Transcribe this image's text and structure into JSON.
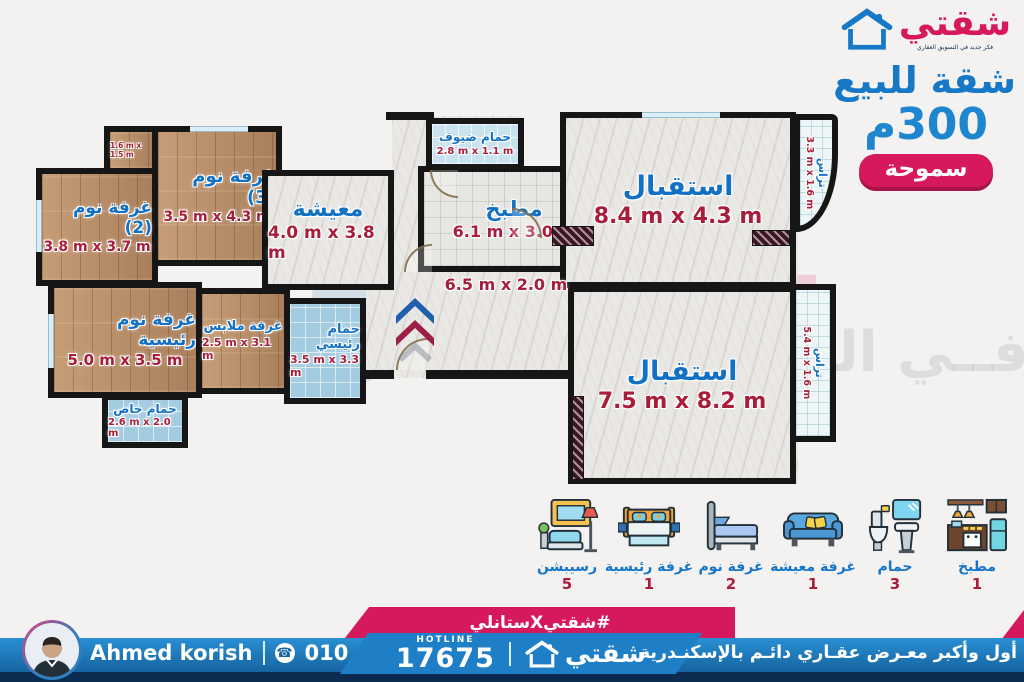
{
  "side_panel": {
    "logo_text": "شقتي",
    "logo_tagline": "فكر جديد في التسويق العقاري",
    "title": "شقة للبيع",
    "area": "300م",
    "location_badge": "سموحة"
  },
  "floor_plan": {
    "rooms": [
      {
        "name": "غرفة نوم (3)",
        "dims": "3.5 m x 4.3 m"
      },
      {
        "name": "غرفة نوم (2)",
        "dims": "3.8 m x 3.7 m"
      },
      {
        "name": "غرفة نوم رئيسية",
        "dims": "5.0 m x 3.5 m"
      },
      {
        "name": "غرفة ملابس",
        "dims": "2.5 m x 3.1 m"
      },
      {
        "name": "حمام رئيسي",
        "dims": "3.5 m x 3.3 m"
      },
      {
        "name": "حمام خاص",
        "dims": "2.6 m x 2.0 m"
      },
      {
        "name": "معيشة",
        "dims": "4.0 m x 3.8 m"
      },
      {
        "name": "حمام ضيوف",
        "dims": "2.8 m x 1.1 m"
      },
      {
        "name": "مطبخ",
        "dims": "6.1 m x 3.0 m"
      },
      {
        "name": "استقبال",
        "dims": "8.4 m x 4.3 m"
      },
      {
        "name": "استقبال",
        "dims": "7.5 m x 8.2 m"
      },
      {
        "name": "تراس",
        "dims": "3.3 m x 1.6 m"
      },
      {
        "name": "تراس",
        "dims": "5.4 m x 1.6 m"
      },
      {
        "name": "",
        "dims": "6.5 m x 2.0 m"
      },
      {
        "name": "",
        "dims": "1.6 m x 1.5 m"
      }
    ],
    "watermark_slogan": "فــي التســويــق العقــاري"
  },
  "legend": {
    "items": [
      {
        "label": "رسيبشن",
        "count": "5",
        "icon": "reception-icon"
      },
      {
        "label": "غرفة رئيسية",
        "count": "1",
        "icon": "master-bed-icon"
      },
      {
        "label": "غرفة نوم",
        "count": "2",
        "icon": "single-bed-icon"
      },
      {
        "label": "غرفة معيشة",
        "count": "1",
        "icon": "living-sofa-icon"
      },
      {
        "label": "حمام",
        "count": "3",
        "icon": "bathroom-icon"
      },
      {
        "label": "مطبخ",
        "count": "1",
        "icon": "kitchen-icon"
      }
    ]
  },
  "footer": {
    "agent_name": "Ahmed korish",
    "agent_phone": "010 400 633 90",
    "hashtag": "#شقتيXستانلي",
    "hotline_label": "HOTLINE",
    "hotline_number": "17675",
    "brand": "شقتي",
    "tagline": "أول وأكبر معـرض عقـاري دائـم بالإسكنـدرية"
  },
  "colors": {
    "primary_blue": "#1778c8",
    "magenta": "#d6195c",
    "dim_red": "#a81e3a",
    "navy": "#0c2b50",
    "wood": "#b88c66",
    "tile_blue": "#a4cce0",
    "marble": "#eae8e5"
  }
}
